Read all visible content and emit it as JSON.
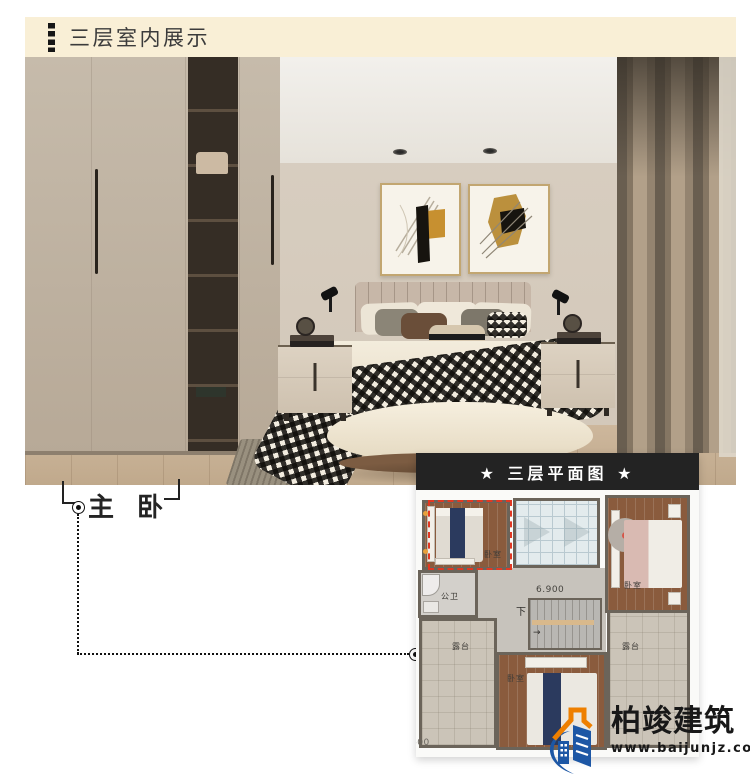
{
  "header": {
    "title": "三层室内展示",
    "bg_color": "#f9efd6",
    "accent_icon": "black-dashed-bar"
  },
  "room_label": {
    "text": "主 卧"
  },
  "photo": {
    "palette": {
      "wall": "#d8cdbf",
      "wardrobe": "#beb1a1",
      "shelving": "#352d25",
      "curtain_dark": "#695e50",
      "curtain_light": "#b2a089",
      "floor_wood": "#c9b193",
      "headboard": "#c7b7a8",
      "duvet": "#f1ead9",
      "throw_brown": "#8f6e52",
      "gingham_black": "#1a1a1a"
    }
  },
  "floor_plan": {
    "title": "★ 三层平面图 ★",
    "title_bg": "#232323",
    "highlight_color": "#e23822",
    "elevation_label": "6.900",
    "stairs_label": "下",
    "partial_dimension": "600",
    "rooms": {
      "master_bedroom": {
        "label": "卧室",
        "highlighted": true
      },
      "bedroom_right": {
        "label": "卧室",
        "highlighted": false
      },
      "bathroom": {
        "label": "公卫",
        "highlighted": false
      },
      "terrace_left": {
        "label": "露台",
        "highlighted": false
      },
      "terrace_right": {
        "label": "露台",
        "highlighted": false
      },
      "bedroom_bottom": {
        "label": "卧室",
        "highlighted": false
      }
    }
  },
  "icons": {
    "arrow_right": "→"
  },
  "logo": {
    "name": "柏竣建筑",
    "website": "www.baijunjz.com",
    "blue": "#1d57a5",
    "orange": "#ee7f00"
  }
}
